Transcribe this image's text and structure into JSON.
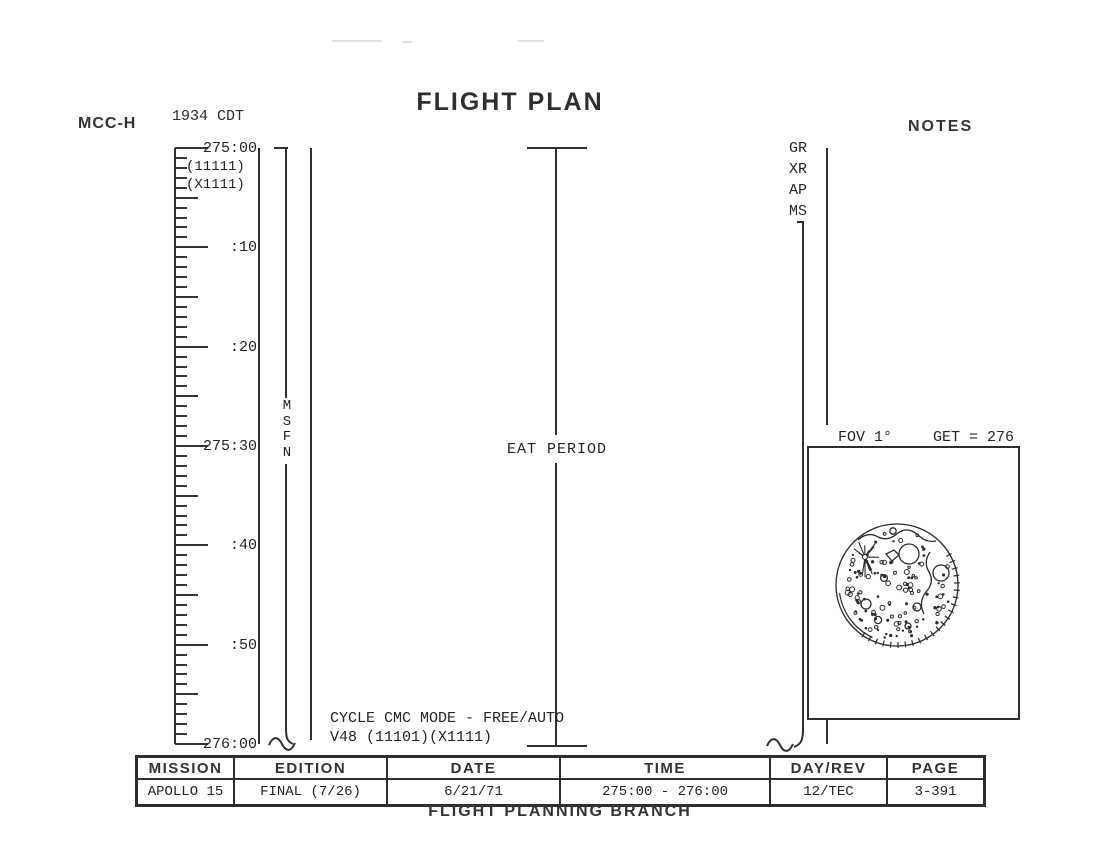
{
  "page": {
    "title": "FLIGHT PLAN",
    "mcc_label": "MCC-H",
    "cdt_time": "1934 CDT",
    "notes_label": "NOTES",
    "footer": "FLIGHT PLANNING BRANCH"
  },
  "timeline": {
    "ruler_labels": [
      {
        "min": 0,
        "text": "275:00"
      },
      {
        "min": 10,
        "text": ":10"
      },
      {
        "min": 20,
        "text": ":20"
      },
      {
        "min": 30,
        "text": "275:30"
      },
      {
        "min": 40,
        "text": ":40"
      },
      {
        "min": 50,
        "text": ":50"
      },
      {
        "min": 60,
        "text": "276:00"
      }
    ],
    "config_labels": [
      "(11111)",
      "(X1111)"
    ],
    "msfn_label": "MSFN",
    "eat_period_label": "EAT PERIOD",
    "cycle_note_line1": "CYCLE CMC MODE - FREE/AUTO",
    "cycle_note_line2": "V48 (11101)(X1111)"
  },
  "notes_column": {
    "sensor_labels": [
      "GR",
      "XR",
      "AP",
      "MS"
    ],
    "fov_label": "FOV 1°",
    "get_label": "GET = 276"
  },
  "footer_table": {
    "columns": [
      {
        "header": "MISSION",
        "value": "APOLLO 15"
      },
      {
        "header": "EDITION",
        "value": "FINAL (7/26)"
      },
      {
        "header": "DATE",
        "value": "6/21/71"
      },
      {
        "header": "TIME",
        "value": "275:00 - 276:00"
      },
      {
        "header": "DAY/REV",
        "value": "12/TEC"
      },
      {
        "header": "PAGE",
        "value": "3-391"
      }
    ]
  },
  "colors": {
    "ink": "#2e2e2e",
    "paper": "#ffffff"
  }
}
